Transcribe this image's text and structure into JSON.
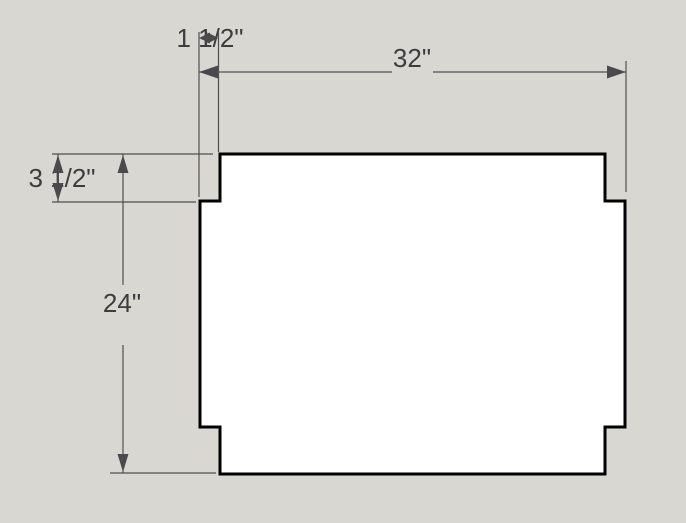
{
  "canvas": {
    "background_color": "#d8d7d2",
    "width_px": 686,
    "height_px": 523
  },
  "drawing": {
    "description": "Technical drawing of a rectangular panel with four notched corners",
    "shape": {
      "name": "notched-panel",
      "fill_color": "#ffffff",
      "outline_color": "#000000"
    },
    "dimension_style": {
      "line_color": "#4f4f52",
      "text_color": "#3d3d40"
    },
    "dimensions": {
      "notch_width": {
        "label": "1 1/2\"",
        "value_inches": 1.5,
        "orientation": "horizontal"
      },
      "overall_width": {
        "label": "32\"",
        "value_inches": 32,
        "orientation": "horizontal"
      },
      "notch_height": {
        "label": "3 1/2\"",
        "value_inches": 3.5,
        "orientation": "vertical"
      },
      "overall_height": {
        "label": "24\"",
        "value_inches": 24,
        "orientation": "vertical"
      }
    }
  }
}
